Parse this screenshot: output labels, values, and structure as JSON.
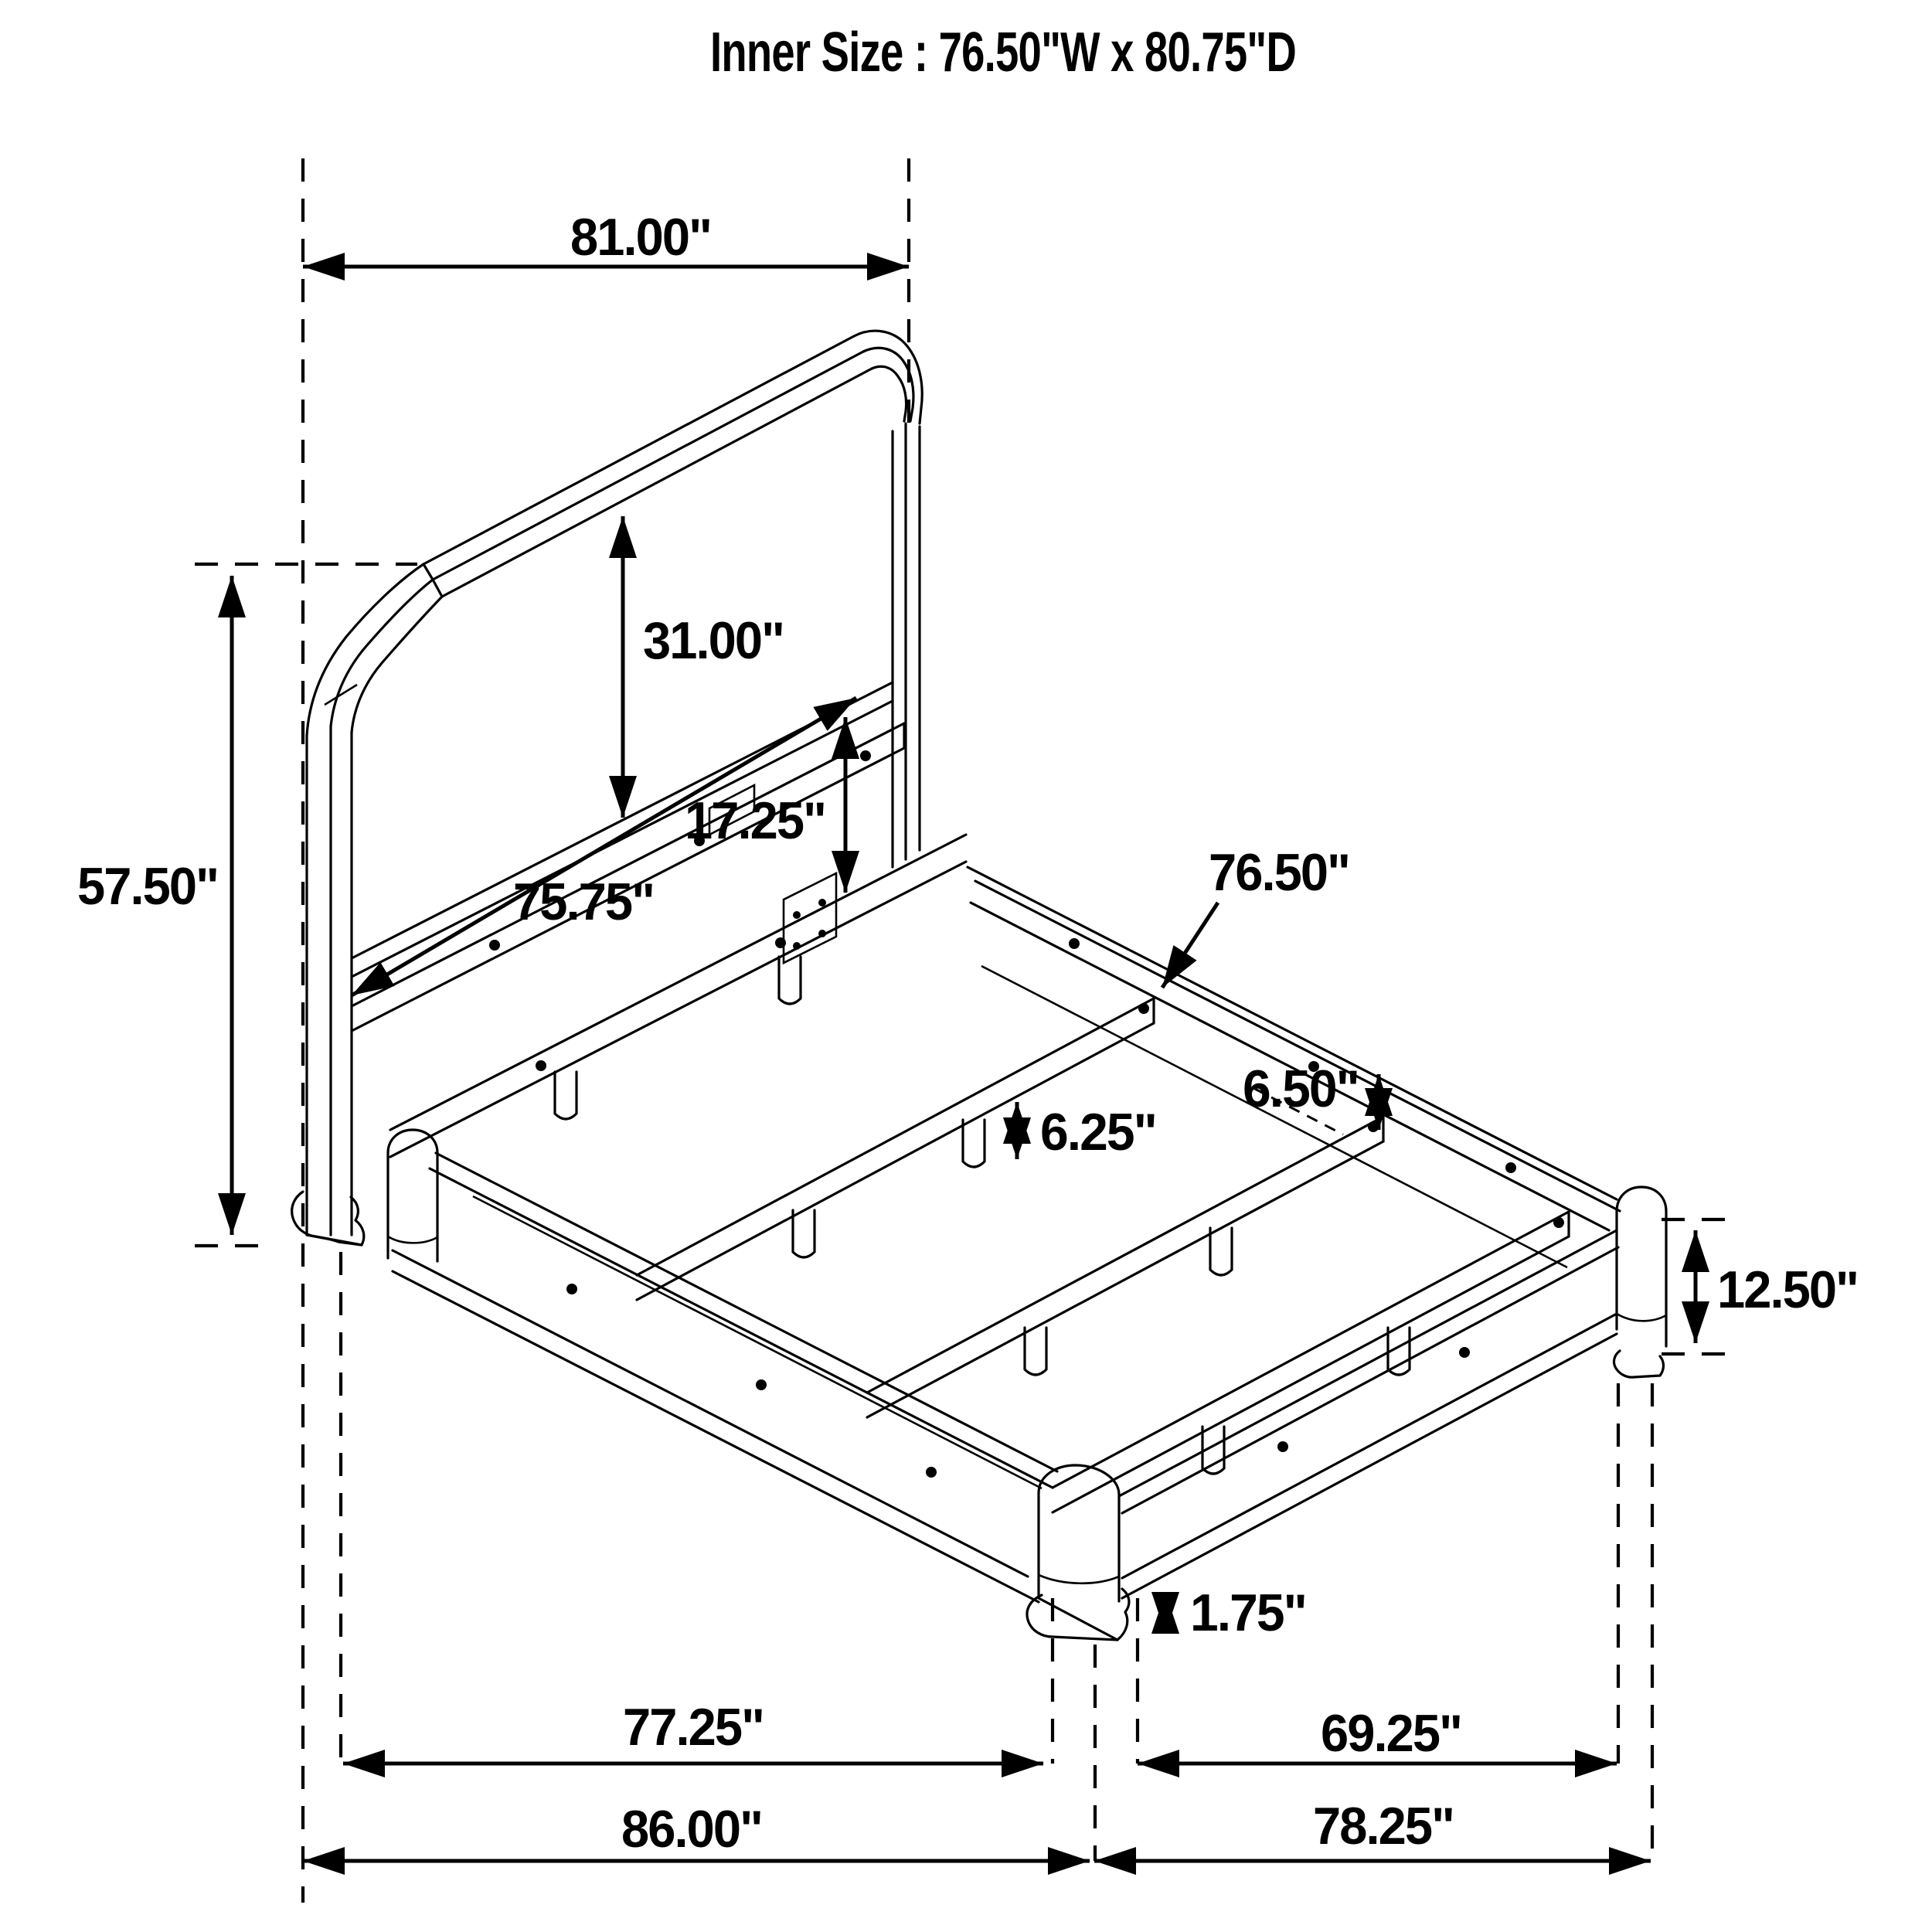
{
  "title": "Inner Size : 76.50\"W x 80.75\"D",
  "inner_size": {
    "width_in": 76.5,
    "depth_in": 80.75
  },
  "units": "inches",
  "colors": {
    "line": "#000000",
    "background": "#ffffff"
  },
  "dimensions": {
    "headboard_width": {
      "label": "81.00\"",
      "value": 81.0
    },
    "headboard_height": {
      "label": "57.50\"",
      "value": 57.5
    },
    "panel_height": {
      "label": "31.00\"",
      "value": 31.0
    },
    "rail_to_floor": {
      "label": "17.25\"",
      "value": 17.25
    },
    "support_rail_length": {
      "label": "75.75\"",
      "value": 75.75
    },
    "slat_length": {
      "label": "76.50\"",
      "value": 76.5
    },
    "slat_gap_far": {
      "label": "6.50\"",
      "value": 6.5
    },
    "slat_gap_near": {
      "label": "6.25\"",
      "value": 6.25
    },
    "frame_height": {
      "label": "12.50\"",
      "value": 12.5
    },
    "foot_height": {
      "label": "1.75\"",
      "value": 1.75
    },
    "side_rail_inner": {
      "label": "77.25\"",
      "value": 77.25
    },
    "foot_rail_inner": {
      "label": "69.25\"",
      "value": 69.25
    },
    "overall_depth": {
      "label": "86.00\"",
      "value": 86.0
    },
    "overall_width": {
      "label": "78.25\"",
      "value": 78.25
    }
  }
}
